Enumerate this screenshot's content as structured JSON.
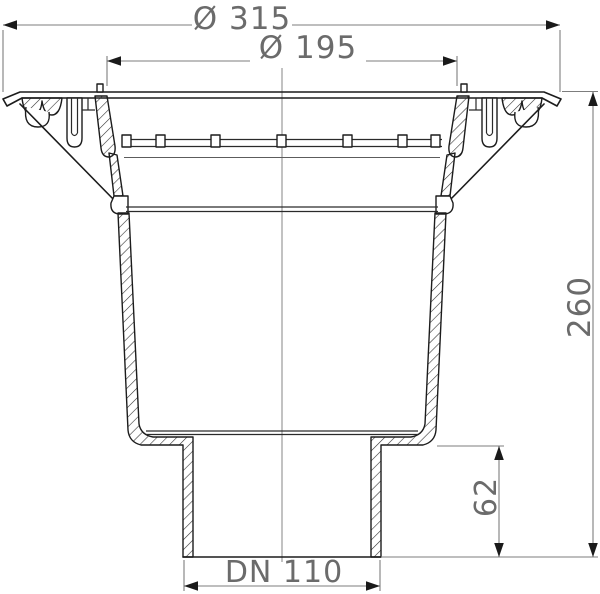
{
  "drawing": {
    "type": "sectional technical drawing of a floor drain with clamping flange and vertical DN110 outlet",
    "dimensions": {
      "outer_diameter": "Ø 315",
      "inner_diameter": "Ø 195",
      "total_height": "260",
      "outlet_length": "62",
      "outlet_nominal": "DN 110"
    },
    "colors": {
      "background": "#ffffff",
      "body_line": "#1c1c1c",
      "dimension_line": "#7d7d7d",
      "dimension_text": "#6b6b6b"
    }
  }
}
